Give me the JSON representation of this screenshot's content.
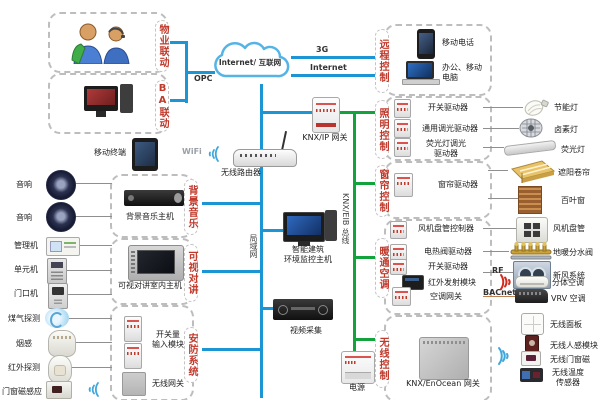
{
  "colors": {
    "lan_line_blue": "#1b95d4",
    "bus_line_green": "#12a33c",
    "group_label_red": "#c0392b",
    "dashed_border_gray": "#bdbdbd"
  },
  "cloud": {
    "label": "Internet/ 互联网"
  },
  "net": {
    "g3": "3G",
    "internet": "Internet",
    "opc": "OPC",
    "wifi": "WiFi",
    "lan": "局域网",
    "bus": "KNX/EIB 总线",
    "rf": "RF",
    "bacnet": "BACnet"
  },
  "labels": {
    "wuye": "物业联动",
    "ba": "BA联动",
    "music": "背景音乐",
    "intercom": "可视对讲",
    "security": "安防系统",
    "remote": "远程控制",
    "lighting": "照明控制",
    "curtain": "窗帘控制",
    "hvac": "暖通空调",
    "wireless": "无线控制"
  },
  "dev": {
    "mobile_terminal": "移动终端",
    "speaker": "音响",
    "music_host": "背景音乐主机",
    "manager": "管理机",
    "unit": "单元机",
    "door": "门口机",
    "intercom_host": "可视对讲室内主机",
    "gas": "煤气探测",
    "smoke": "烟感",
    "ir": "红外探测",
    "magnet": "门窗磁感应",
    "switch_input": "开关量\n输入模块",
    "wireless_gw": "无线网关",
    "router": "无线路由器",
    "building_host": "智能建筑\n环境监控主机",
    "video": "视频采集",
    "knxip": "KNX/IP 网关",
    "power": "电源",
    "enocean": "KNX/EnOcean 网关",
    "phone": "移动电话",
    "pc": "办公、移动\n电脑",
    "drv_switch": "开关驱动器",
    "drv_dimmer": "通用调光驱动器",
    "drv_fluor": "荧光灯调光\n驱动器",
    "lamp_cfl": "节能灯",
    "lamp_halogen": "卤素灯",
    "lamp_fluor": "荧光灯",
    "drv_curtain": "窗帘驱动器",
    "tgt_awning": "遮阳卷帘",
    "tgt_blind": "百叶窗",
    "drv_fancoil": "风机盘管控制器",
    "tgt_fancoil": "风机盘管",
    "drv_valve": "电热阀驱动器",
    "tgt_manifold": "地暖分水阀",
    "drv_switch2": "开关驱动器",
    "tgt_fresh": "新风系统",
    "drv_ir": "红外发射模块",
    "tgt_split": "分体空调",
    "drv_acgw": "空调网关",
    "tgt_vrv": "VRV 空调",
    "tgt_wpanel": "无线面板",
    "tgt_wpir": "无线人感模块",
    "tgt_wmag": "无线门窗磁",
    "tgt_wtemp": "无线温度\n传感器"
  }
}
